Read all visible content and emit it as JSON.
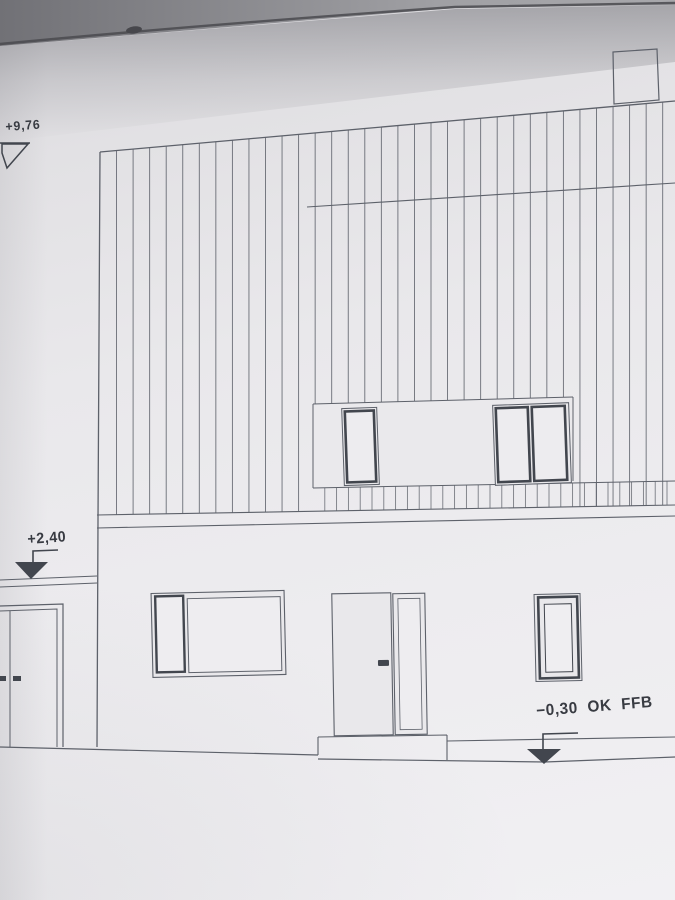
{
  "drawing": {
    "kind": "house rear elevation",
    "annotations": {
      "roof_level": "+9,76",
      "canopy_level": "+2,40",
      "floor_level": "−0,30 OK FFB"
    },
    "icons": {
      "roof_level_marker": "level-marker-icon",
      "canopy_level_marker": "level-marker-icon",
      "floor_level_marker": "level-marker-icon"
    }
  },
  "colors": {
    "paper": "#eceaed",
    "line": "#5d616a",
    "frame_dark": "#42464e",
    "text": "#383b42",
    "backdrop_dark": "#717176",
    "backdrop_light": "#a0a0a4",
    "edge_line": "#4a4a4f"
  }
}
